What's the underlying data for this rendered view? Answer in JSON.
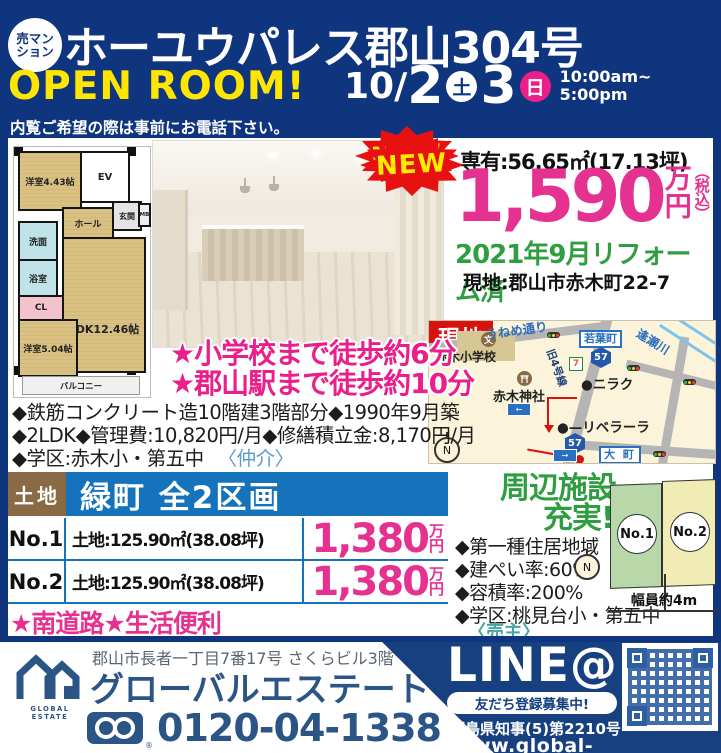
{
  "colors": {
    "navy": "#10357f",
    "yellow": "#ffe600",
    "magenta": "#e5318f",
    "pink_day": "#ea1f8a",
    "green": "#2f9e41",
    "land_blue": "#1573bb",
    "brown": "#8a6a45",
    "burst_red": "#e81111",
    "site_red": "#d6130f",
    "footer_navy": "#16407f",
    "company_navy": "#2b5585"
  },
  "header": {
    "badge_line1": "売マン",
    "badge_line2": "ション",
    "title": "ホーユウパレス郡山304号",
    "open_room": "OPEN ROOM!",
    "date_month": "10/",
    "date_day1": "2",
    "date_day1_dow": "土",
    "date_day2": "3",
    "date_day2_dow": "日",
    "time_from": "10:00am~",
    "time_to": "5:00pm",
    "notice": "内覧ご希望の際は事前にお電話下さい。"
  },
  "mansion": {
    "new_badge": "NEW",
    "area_label": "専有:56.65㎡(17.13坪)",
    "price_value": "1,590",
    "price_unit_top": "万",
    "price_unit_bottom": "円",
    "price_tax_note": "（税込）",
    "reform_note": "2021年9月リフォーム済",
    "site_label": "現地:郡山市赤木町22-7",
    "feature1": "★小学校まで徒歩約6分",
    "feature2": "★郡山駅まで徒歩約10分",
    "detail1": "◆鉄筋コンクリート造10階建3階部分◆1990年9月築",
    "detail2": "◆2LDK◆管理費:10,820円/月◆修繕積立金:8,170円/月",
    "detail3": "◆学区:赤木小・第五中",
    "broker_note": "〈仲介〉",
    "floorplan": {
      "room_west1": "洋室4.43帖",
      "ev": "EV",
      "hall": "ホール",
      "entrance": "玄関",
      "mb": "MB",
      "washroom": "洗面",
      "bath": "浴室",
      "closet": "CL",
      "ldk": "LDK12.46帖",
      "room_west2": "洋室5.04帖",
      "balcony": "バルコニー"
    },
    "map": {
      "street1": "うねめ通り",
      "town1": "若葉町",
      "river": "逢瀬川",
      "route_old": "旧4号線",
      "school": "赤木小学校",
      "school_icon": "文",
      "shrine": "赤木神社",
      "store1": "●ニラク",
      "store2": "●—リベラーラ",
      "route_57a": "57",
      "route_57b": "57",
      "seven": "7",
      "site_marker": "現地",
      "town2": "大 町",
      "compass": "N"
    }
  },
  "land": {
    "tag": "土地",
    "title": "緑町 全2区画",
    "new_badge": "NEW",
    "rows": [
      {
        "no": "No.1",
        "size": "土地:125.90㎡(38.08坪)",
        "price": "1,380",
        "unit_top": "万",
        "unit_bottom": "円"
      },
      {
        "no": "No.2",
        "size": "土地:125.90㎡(38.08坪)",
        "price": "1,380",
        "unit_top": "万",
        "unit_bottom": "円"
      }
    ],
    "stars": "★南道路★生活便利",
    "nearby_line1": "周辺施設",
    "nearby_line2": "充実!",
    "detail1": "◆第一種住居地域",
    "detail2": "◆建ぺい率:60%",
    "detail3": "◆容積率:200%",
    "detail4": "◆学区:桃見台小・第五中",
    "seller_note": "〈売主〉",
    "diagram": {
      "lot1": "No.1",
      "lot2": "No.2",
      "road_width": "幅員約4m",
      "compass": "N"
    }
  },
  "footer": {
    "address": "郡山市長者一丁目7番17号 さくらビル3階",
    "company": "グローバルエステート",
    "logo_caption": "GLOBAL ESTATE",
    "phone": "0120-04-1338",
    "phone_reg": "®",
    "line_label": "LINE@",
    "line_cta": "友だち登録募集中!",
    "license": "福島県知事(5)第2210号",
    "url": "www.global-estate33.com"
  }
}
